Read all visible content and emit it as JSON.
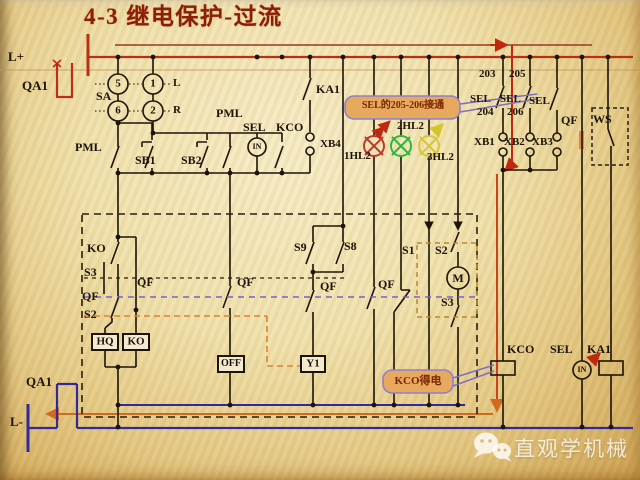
{
  "colors": {
    "bus_positive": "#b93016",
    "bus_negative": "#312a9b",
    "highlight_orange": "#d2691e",
    "lamp_red": "#c03828",
    "lamp_green": "#2db83d",
    "lamp_yellow": "#d4c52e",
    "callout_fill": "#e7a95e",
    "callout_border": "#8f7fd0",
    "title_color": "#8e1f04"
  },
  "title": "4-3  继电保护-过流",
  "rails": {
    "l_plus": "L+",
    "l_minus": "L-"
  },
  "breaker": {
    "top": "QA1",
    "bottom": "QA1"
  },
  "selector": {
    "name": "SA",
    "c5": "5",
    "c1": "1",
    "c6": "6",
    "c2": "2",
    "left": "L",
    "right": "R"
  },
  "row1": {
    "pml_left": "PML",
    "sb1": "SB1",
    "sb2": "SB2",
    "pml_right": "PML",
    "sel": "SEL",
    "kco": "KCO",
    "in": "IN",
    "ka1": "KA1",
    "xb4": "XB4"
  },
  "lamps": {
    "red": "1HL2",
    "green": "2HL2",
    "yellow": "3HL2"
  },
  "sel_block": {
    "t203": "203",
    "t205": "205",
    "t204": "204",
    "t206": "206",
    "sel1": "SEL",
    "sel2": "SEL",
    "sel3": "SEL",
    "xb1": "XB1",
    "xb2": "XB2",
    "xb3": "XB3",
    "qf": "QF",
    "ws": "WS"
  },
  "interlock": {
    "ko": "KO",
    "s3": "S3",
    "qf_a": "QF",
    "s2": "S2",
    "hq": "HQ",
    "ko_coil": "KO",
    "qf_b": "QF",
    "qf_c": "QF",
    "off": "OFF",
    "s9": "S9",
    "s8": "S8",
    "qf_d": "QF",
    "qf_e": "QF",
    "y1": "Y1",
    "s1": "S1",
    "s2_m": "S2",
    "motor": "M",
    "s3_m": "S3"
  },
  "output": {
    "kco": "KCO",
    "sel": "SEL",
    "in": "IN",
    "ka1": "KA1"
  },
  "callouts": {
    "sel_note": "SEL的205-206接通",
    "kco_note": "KCO得电"
  },
  "watermark": "直观学机械"
}
